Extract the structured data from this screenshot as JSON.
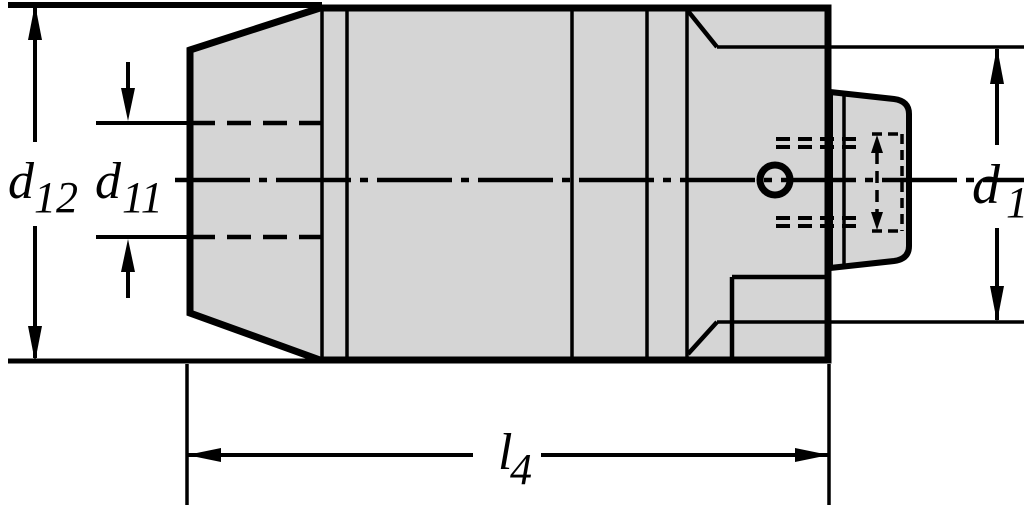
{
  "labels": {
    "d12": {
      "base": "d",
      "sub": "12"
    },
    "d11": {
      "base": "d",
      "sub": "11"
    },
    "l4": {
      "base": "l",
      "sub": "4"
    },
    "d1": {
      "base": "d",
      "sub": "1"
    }
  },
  "colors": {
    "body_fill": "#d5d5d5",
    "line": "#000000",
    "background": "#ffffff"
  }
}
